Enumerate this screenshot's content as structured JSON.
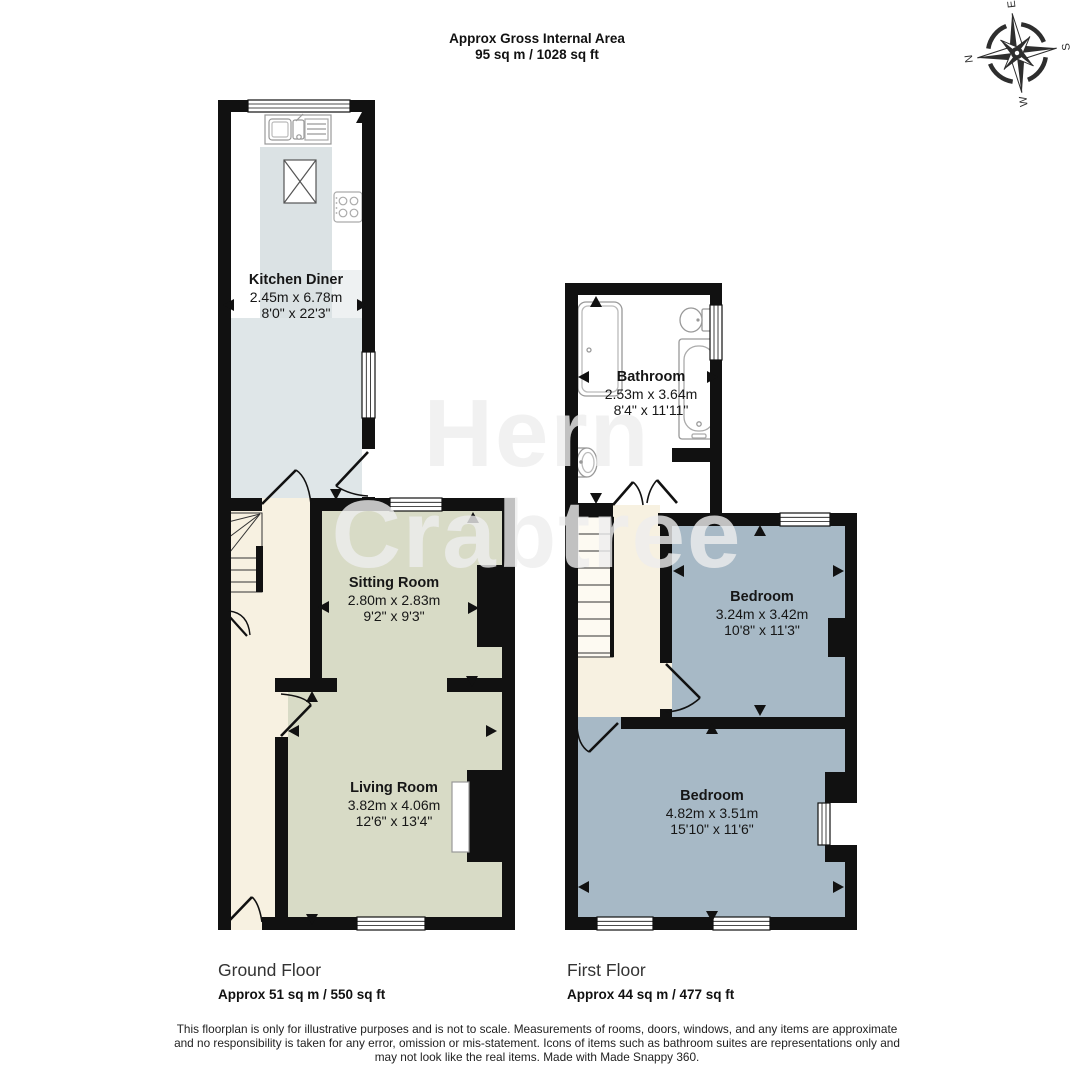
{
  "header": {
    "title_line1": "Approx Gross Internal Area",
    "title_line2": "95 sq m / 1028 sq ft"
  },
  "compass": {
    "n": "N",
    "e": "E",
    "s": "S",
    "w": "W"
  },
  "watermark": {
    "line1": "Hern",
    "line2": "Crabtree"
  },
  "rooms": {
    "kitchen": {
      "name": "Kitchen Diner",
      "metric": "2.45m x 6.78m",
      "imperial": "8'0\" x 22'3\""
    },
    "sitting": {
      "name": "Sitting Room",
      "metric": "2.80m x 2.83m",
      "imperial": "9'2\" x 9'3\""
    },
    "living": {
      "name": "Living Room",
      "metric": "3.82m x 4.06m",
      "imperial": "12'6\" x 13'4\""
    },
    "bathroom": {
      "name": "Bathroom",
      "metric": "2.53m x 3.64m",
      "imperial": "8'4\" x 11'11\""
    },
    "bedroom1": {
      "name": "Bedroom",
      "metric": "3.24m x 3.42m",
      "imperial": "10'8\" x 11'3\""
    },
    "bedroom2": {
      "name": "Bedroom",
      "metric": "4.82m x 3.51m",
      "imperial": "15'10\" x 11'6\""
    }
  },
  "floors": {
    "ground": {
      "label": "Ground Floor",
      "area": "Approx 51 sq m / 550 sq ft"
    },
    "first": {
      "label": "First Floor",
      "area": "Approx 44 sq m / 477 sq ft"
    }
  },
  "disclaimer": {
    "line1": "This floorplan is only for illustrative purposes and is not to scale. Measurements of rooms, doors, windows, and any items are approximate",
    "line2": "and no responsibility is taken for any error, omission or mis-statement. Icons of items such as bathroom suites are representations only and",
    "line3": "may not look like the real items. Made with Made Snappy 360."
  },
  "colors": {
    "wall": "#111111",
    "sage_room": "#d8dbc6",
    "hall_cream": "#f7f1e1",
    "bedroom_blue": "#a7b9c6",
    "kitchen_blue": "#dfe6e8",
    "counter": "#dbe2e4",
    "bathroom_white": "#ffffff"
  }
}
